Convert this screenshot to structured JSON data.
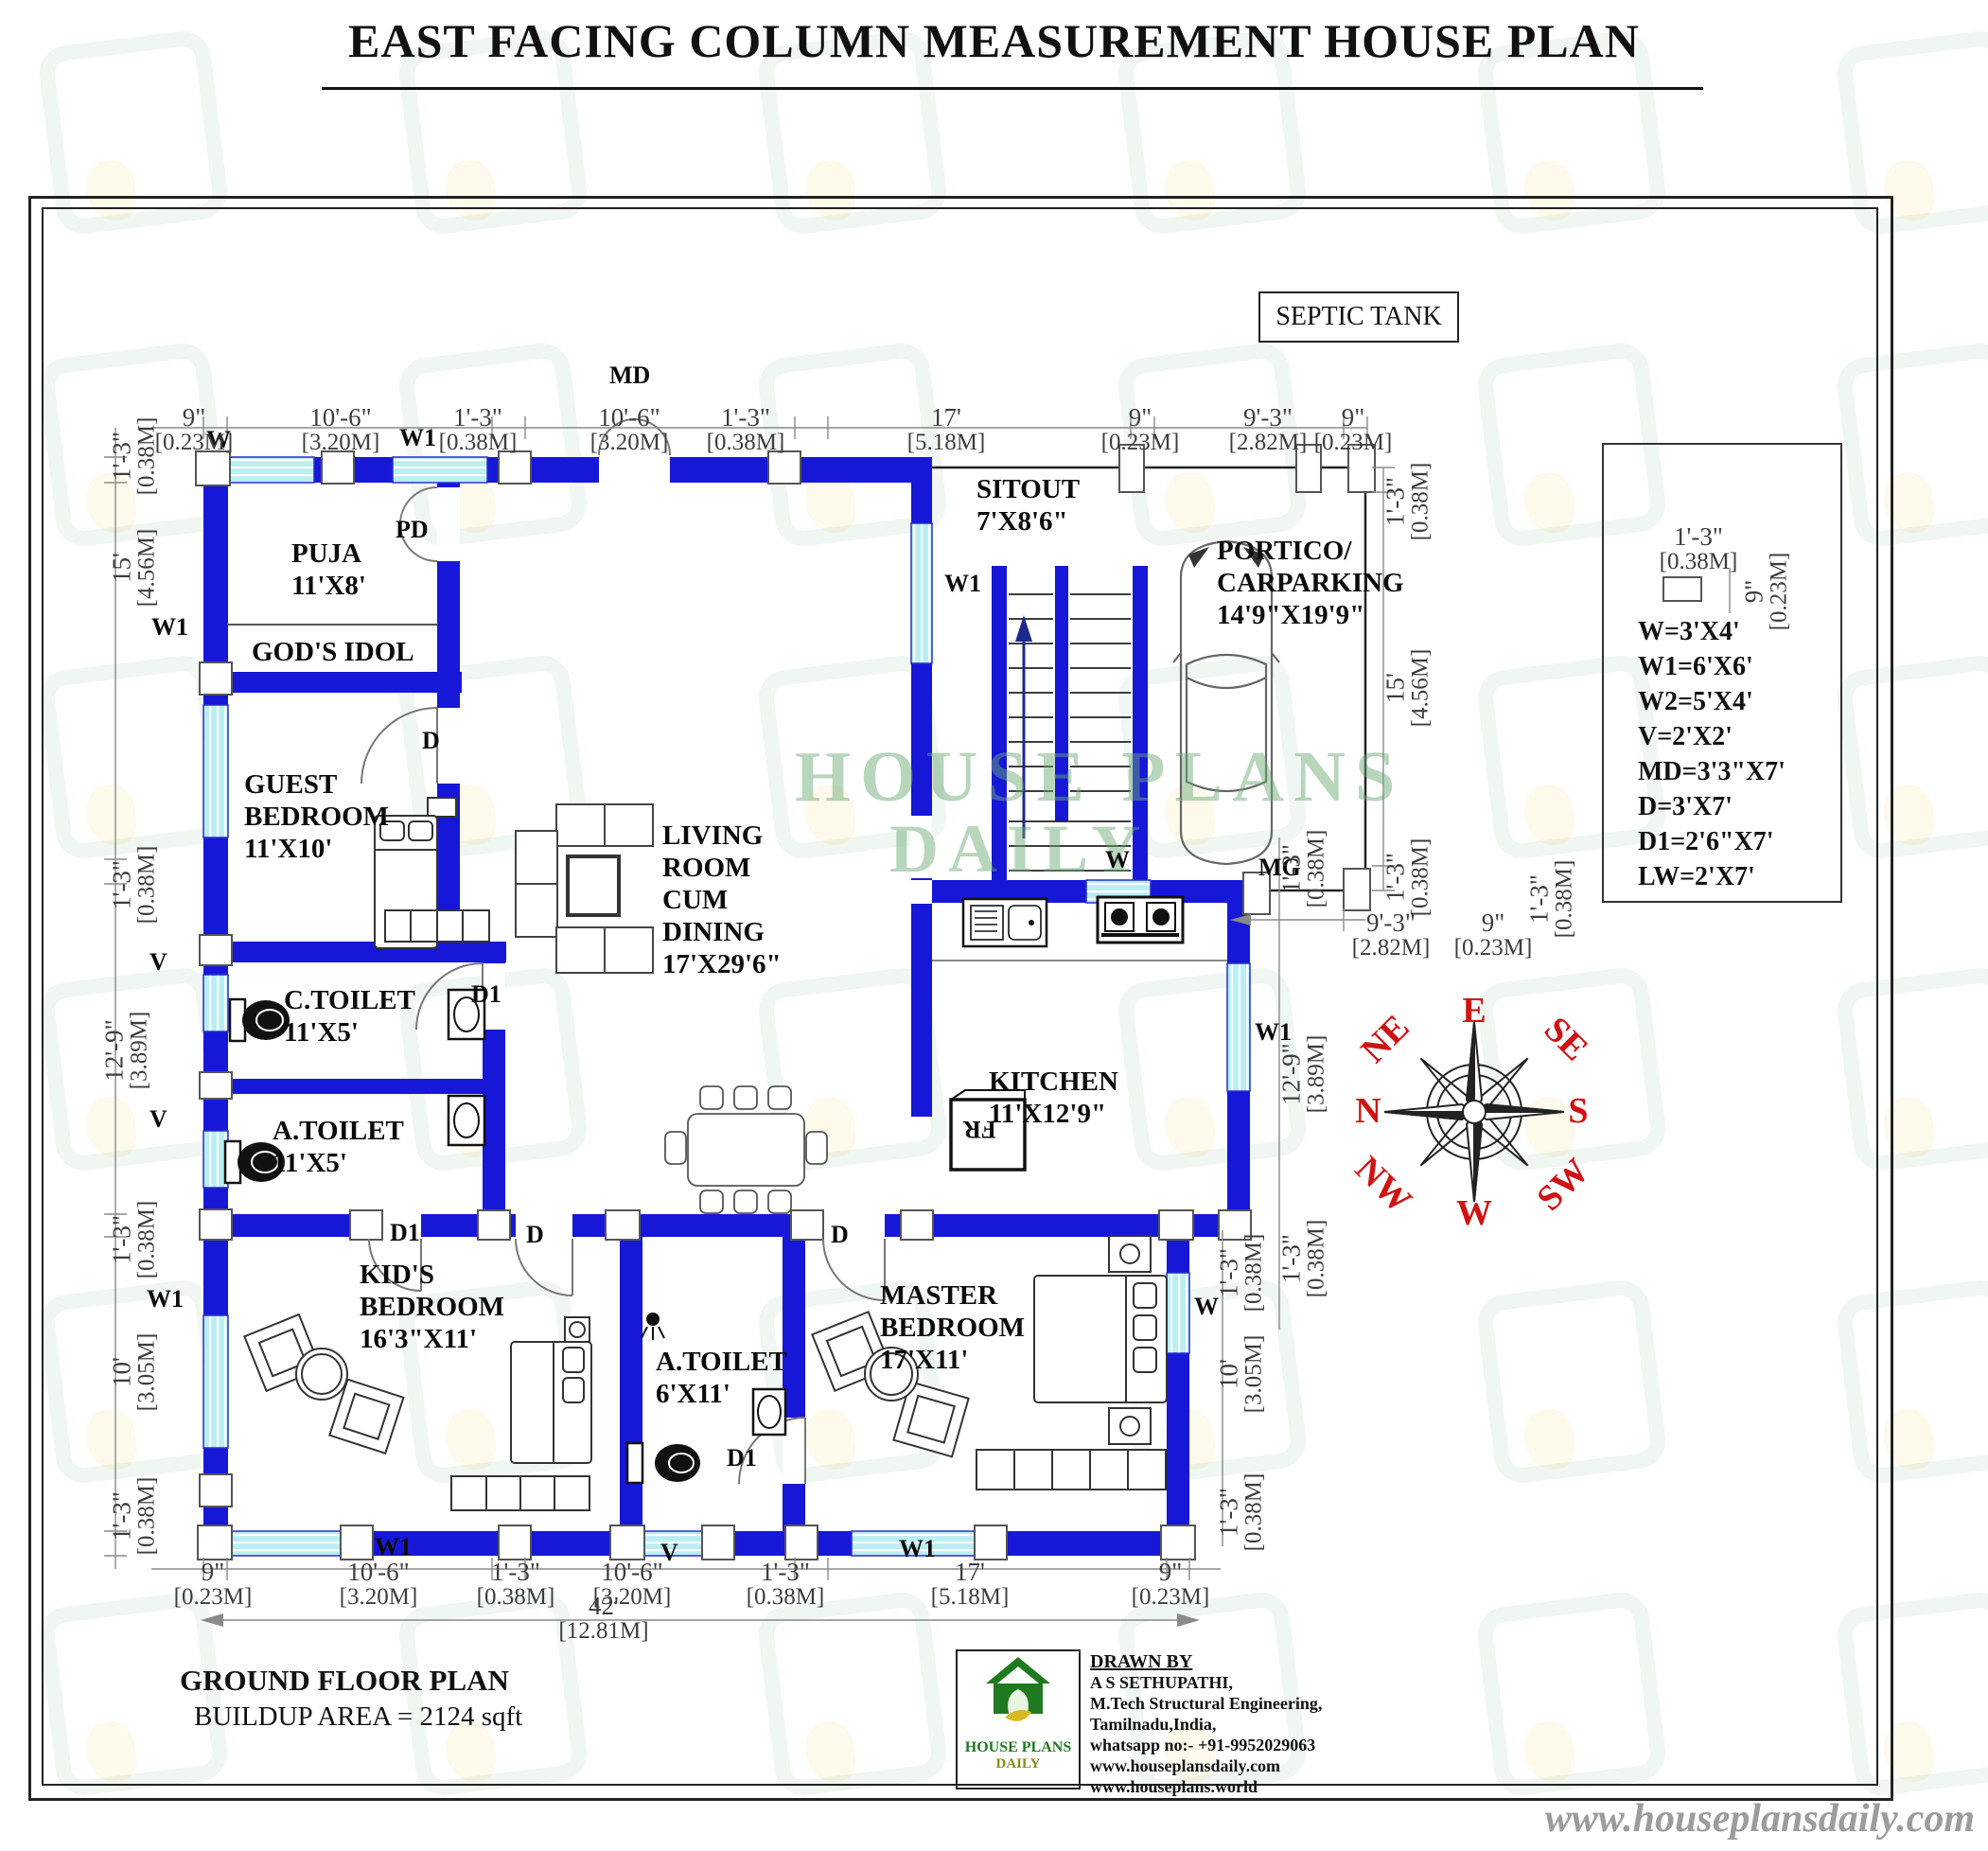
{
  "title": "EAST FACING COLUMN MEASUREMENT HOUSE PLAN",
  "septic_tank": "SEPTIC TANK",
  "watermark": {
    "line1": "HOUSE PLANS",
    "line2": "DAILY"
  },
  "rooms": {
    "puja": {
      "lines": [
        "PUJA",
        "11'X8'"
      ]
    },
    "gods_idol": {
      "lines": [
        "GOD'S IDOL"
      ]
    },
    "guest": {
      "lines": [
        "GUEST",
        "BEDROOM",
        "11'X10'"
      ]
    },
    "c_toilet": {
      "lines": [
        "C.TOILET",
        "11'X5'"
      ]
    },
    "a_toilet": {
      "lines": [
        "A.TOILET",
        "11'X5'"
      ]
    },
    "kids": {
      "lines": [
        "KID'S",
        "BEDROOM",
        "16'3\"X11'"
      ]
    },
    "living": {
      "lines": [
        "LIVING",
        "ROOM",
        "CUM",
        "DINING",
        "17'X29'6\""
      ]
    },
    "sitout": {
      "lines": [
        "SITOUT",
        "7'X8'6\""
      ]
    },
    "portico": {
      "lines": [
        "PORTICO/",
        "CARPARKING",
        "14'9\"X19'9\""
      ]
    },
    "kitchen": {
      "lines": [
        "KITCHEN",
        "11'X12'9\""
      ]
    },
    "a_toilet2": {
      "lines": [
        "A.TOILET",
        "6'X11'"
      ]
    },
    "master": {
      "lines": [
        "MASTER",
        "BEDROOM",
        "17'X11'"
      ]
    }
  },
  "markers": {
    "w": "W",
    "w1": "W1",
    "v": "V",
    "d": "D",
    "d1": "D1",
    "pd": "PD",
    "md": "MD",
    "mg": "MG",
    "fr": "FR"
  },
  "legend": {
    "dim_h_ft": "1'-3\"",
    "dim_h_m": "[0.38M]",
    "dim_v_ft": "9\"",
    "dim_v_m": "[0.23M]",
    "entries": [
      "W=3'X4'",
      "W1=6'X6'",
      "W2=5'X4'",
      "V=2'X2'",
      "MD=3'3\"X7'",
      "D=3'X7'",
      "D1=2'6\"X7'",
      "LW=2'X7'"
    ]
  },
  "compass": {
    "e": "E",
    "se": "SE",
    "s": "S",
    "sw": "SW",
    "w": "W",
    "nw": "NW",
    "n": "N",
    "ne": "NE"
  },
  "dims": {
    "top": [
      {
        "ft": "9\"",
        "m": "[0.23M]"
      },
      {
        "ft": "10'-6\"",
        "m": "[3.20M]"
      },
      {
        "ft": "1'-3\"",
        "m": "[0.38M]"
      },
      {
        "ft": "10'-6\"",
        "m": "[3.20M]"
      },
      {
        "ft": "1'-3\"",
        "m": "[0.38M]"
      },
      {
        "ft": "17'",
        "m": "[5.18M]"
      },
      {
        "ft": "9\"",
        "m": "[0.23M]"
      },
      {
        "ft": "9'-3\"",
        "m": "[2.82M]"
      },
      {
        "ft": "9\"",
        "m": "[0.23M]"
      }
    ],
    "bottom": [
      {
        "ft": "9\"",
        "m": "[0.23M]"
      },
      {
        "ft": "10'-6\"",
        "m": "[3.20M]"
      },
      {
        "ft": "1'-3\"",
        "m": "[0.38M]"
      },
      {
        "ft": "10'-6\"",
        "m": "[3.20M]"
      },
      {
        "ft": "1'-3\"",
        "m": "[0.38M]"
      },
      {
        "ft": "17'",
        "m": "[5.18M]"
      },
      {
        "ft": "9\"",
        "m": "[0.23M]"
      }
    ],
    "left": [
      {
        "ft": "1'-3\"",
        "m": "[0.38M]"
      },
      {
        "ft": "15'",
        "m": "[4.56M]"
      },
      {
        "ft": "1'-3\"",
        "m": "[0.38M]"
      },
      {
        "ft": "12'-9\"",
        "m": "[3.89M]"
      },
      {
        "ft": "1'-3\"",
        "m": "[0.38M]"
      },
      {
        "ft": "10'",
        "m": "[3.05M]"
      },
      {
        "ft": "1'-3\"",
        "m": "[0.38M]"
      }
    ],
    "right_portico": [
      {
        "ft": "1'-3\"",
        "m": "[0.38M]"
      },
      {
        "ft": "15'",
        "m": "[4.56M]"
      },
      {
        "ft": "1'-3\"",
        "m": "[0.38M]"
      }
    ],
    "right_kitchen": [
      {
        "ft": "1'-3\"",
        "m": "[0.38M]"
      },
      {
        "ft": "12'-9\"",
        "m": "[3.89M]"
      },
      {
        "ft": "1'-3\"",
        "m": "[0.38M]"
      }
    ],
    "right_master": [
      {
        "ft": "1'-3\"",
        "m": "[0.38M]"
      },
      {
        "ft": "10'",
        "m": "[3.05M]"
      },
      {
        "ft": "1'-3\"",
        "m": "[0.38M]"
      }
    ],
    "right_extra": {
      "ft": "1'-3\"",
      "m": "[0.38M]"
    },
    "portico_width": [
      {
        "ft": "9'-3\"",
        "m": "[2.82M]"
      },
      {
        "ft": "9\"",
        "m": "[0.23M]"
      }
    ],
    "overall": {
      "ft": "42'",
      "m": "[12.81M]"
    }
  },
  "footer": {
    "plan_name": "GROUND FLOOR PLAN",
    "area": "BUILDUP AREA = 2124 sqft",
    "drawn_by_title": "DRAWN BY",
    "drawn_by_lines": [
      "A S SETHUPATHI,",
      "M.Tech Structural Engineering,",
      "Tamilnadu,India,",
      "whatsapp no:- +91-9952029063",
      "www.houseplansdaily.com",
      "www.houseplans.world"
    ],
    "logo": {
      "line1": "HOUSE PLANS",
      "line2": "DAILY"
    },
    "website": "www.houseplansdaily.com"
  }
}
